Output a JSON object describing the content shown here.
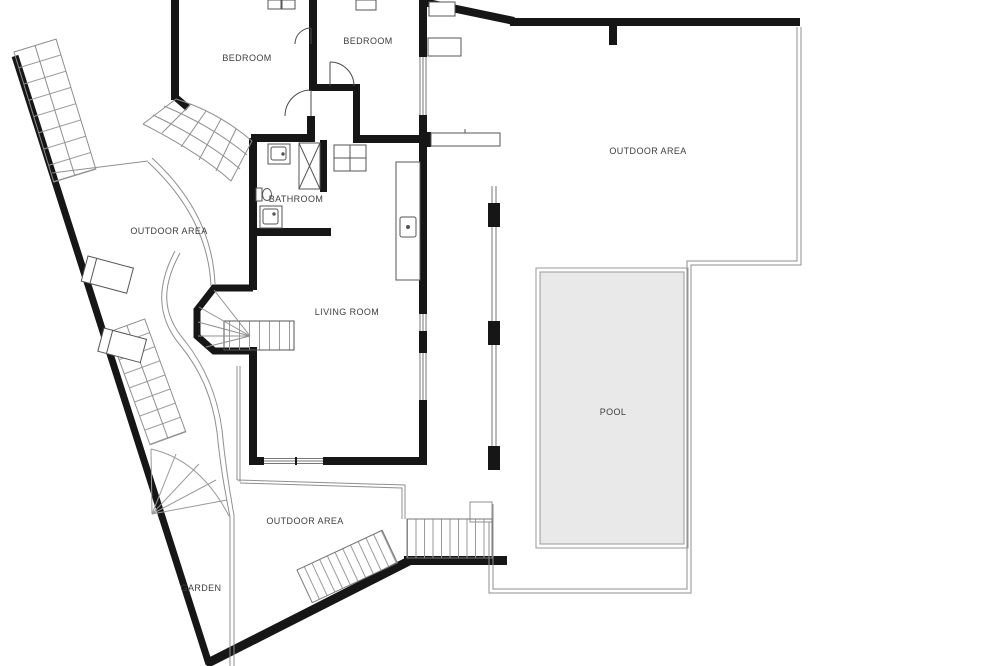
{
  "plan": {
    "type": "residential-floor-plan",
    "rooms": [
      {
        "id": "bedroom-1",
        "label": "BEDROOM"
      },
      {
        "id": "bedroom-2",
        "label": "BEDROOM"
      },
      {
        "id": "bathroom",
        "label": "BATHROOM"
      },
      {
        "id": "outdoor-area-west",
        "label": "OUTDOOR AREA"
      },
      {
        "id": "living-room",
        "label": "LIVING ROOM"
      },
      {
        "id": "outdoor-area-northeast",
        "label": "OUTDOOR AREA"
      },
      {
        "id": "pool",
        "label": "POOL"
      },
      {
        "id": "outdoor-area-south",
        "label": "OUTDOOR AREA"
      },
      {
        "id": "garden",
        "label": "GARDEN"
      }
    ],
    "colors": {
      "wall": "#161616",
      "thin_line": "#8f8f8f",
      "furniture_line": "#555555",
      "pool_fill": "#e9e9e9",
      "pool_border": "#9a9a9a",
      "label_text": "#3d3d3d",
      "background": "#ffffff"
    }
  }
}
